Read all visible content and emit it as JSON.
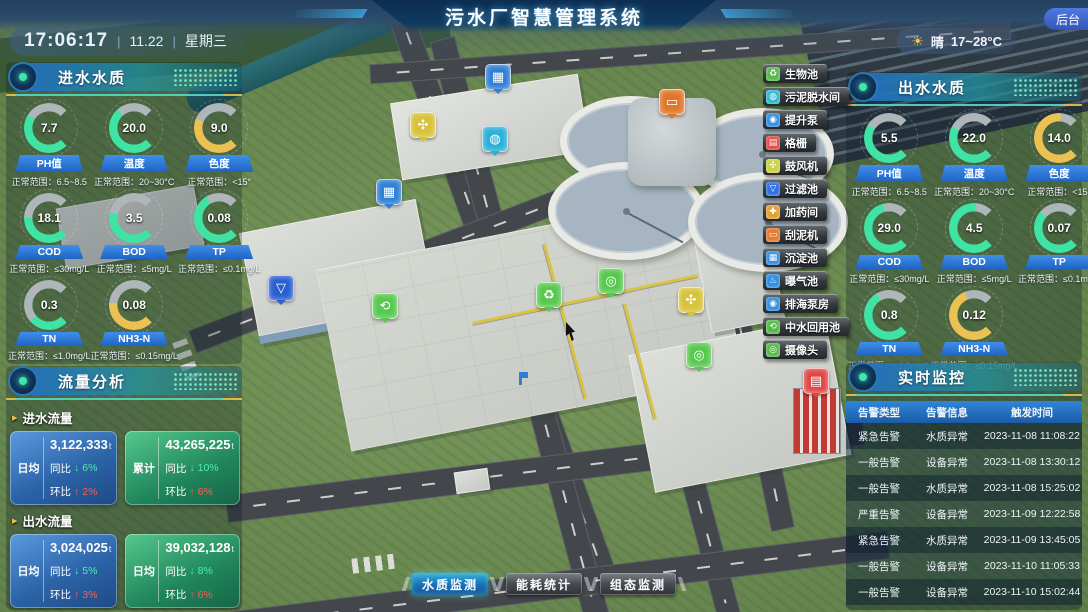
{
  "header": {
    "title": "污水厂智慧管理系统",
    "time": "17:06:17",
    "date": "11.22",
    "weekday": "星期三",
    "sun_icon": "☀",
    "weather_label": "晴",
    "weather_temp": "17~28°C",
    "admin_label": "后台"
  },
  "inlet_quality": {
    "title": "进水水质",
    "gauges": [
      {
        "value": "7.7",
        "label": "PH值",
        "range": "正常范围：6.5~8.5",
        "status": "normal",
        "percent": "62"
      },
      {
        "value": "20.0",
        "label": "温度",
        "range": "正常范围：20~30°C",
        "status": "normal",
        "percent": "68"
      },
      {
        "value": "9.0",
        "label": "色度",
        "range": "正常范围：<15°",
        "status": "warning",
        "percent": "58"
      },
      {
        "value": "18.1",
        "label": "COD",
        "range": "正常范围：≤30mg/L",
        "status": "normal",
        "percent": "50"
      },
      {
        "value": "3.5",
        "label": "BOD",
        "range": "正常范围：≤5mg/L",
        "status": "normal",
        "percent": "55"
      },
      {
        "value": "0.08",
        "label": "TP",
        "range": "正常范围：≤0.1mg/L",
        "status": "normal",
        "percent": "72"
      },
      {
        "value": "0.3",
        "label": "TN",
        "range": "正常范围：≤1.0mg/L",
        "status": "normal",
        "percent": "35"
      },
      {
        "value": "0.08",
        "label": "NH3-N",
        "range": "正常范围：≤0.15mg/L",
        "status": "warning",
        "percent": "52"
      }
    ]
  },
  "outlet_quality": {
    "title": "出水水质",
    "gauges": [
      {
        "value": "5.5",
        "label": "PH值",
        "range": "正常范围：6.5~8.5",
        "status": "normal",
        "percent": "62"
      },
      {
        "value": "22.0",
        "label": "温度",
        "range": "正常范围：20~30°C",
        "status": "normal",
        "percent": "60"
      },
      {
        "value": "14.0",
        "label": "色度",
        "range": "正常范围：<15°",
        "status": "warning",
        "percent": "85"
      },
      {
        "value": "29.0",
        "label": "COD",
        "range": "正常范围：≤30mg/L",
        "status": "normal",
        "percent": "78"
      },
      {
        "value": "4.5",
        "label": "BOD",
        "range": "正常范围：≤5mg/L",
        "status": "normal",
        "percent": "85"
      },
      {
        "value": "0.07",
        "label": "TP",
        "range": "正常范围：≤0.1mg/L",
        "status": "normal",
        "percent": "65"
      },
      {
        "value": "0.8",
        "label": "TN",
        "range": "正常范围：≤1.0mg/L",
        "status": "normal",
        "percent": "72"
      },
      {
        "value": "0.12",
        "label": "NH3-N",
        "range": "正常范围：≤0.15mg/L",
        "status": "warning",
        "percent": "75"
      }
    ]
  },
  "flow": {
    "title": "流量分析",
    "inlet_label": "进水流量",
    "outlet_label": "出水流量",
    "inlet_cards": [
      {
        "tag": "日均",
        "value": "3,122,333",
        "unit": "t",
        "theme": "blue",
        "yoy_label": "同比",
        "yoy_arrow": "↓",
        "yoy_value": "6%",
        "yoy_cls": "down",
        "mom_label": "环比",
        "mom_arrow": "↑",
        "mom_value": "2%",
        "mom_cls": "up"
      },
      {
        "tag": "累计",
        "value": "43,265,225",
        "unit": "t",
        "theme": "green",
        "yoy_label": "同比",
        "yoy_arrow": "↓",
        "yoy_value": "10%",
        "yoy_cls": "down",
        "mom_label": "环比",
        "mom_arrow": "↑",
        "mom_value": "6%",
        "mom_cls": "up"
      }
    ],
    "outlet_cards": [
      {
        "tag": "日均",
        "value": "3,024,025",
        "unit": "t",
        "theme": "blue",
        "yoy_label": "同比",
        "yoy_arrow": "↓",
        "yoy_value": "5%",
        "yoy_cls": "down",
        "mom_label": "环比",
        "mom_arrow": "↑",
        "mom_value": "3%",
        "mom_cls": "up"
      },
      {
        "tag": "日均",
        "value": "39,032,128",
        "unit": "t",
        "theme": "green",
        "yoy_label": "同比",
        "yoy_arrow": "↓",
        "yoy_value": "8%",
        "yoy_cls": "down",
        "mom_label": "环比",
        "mom_arrow": "↑",
        "mom_value": "6%",
        "mom_cls": "up"
      }
    ]
  },
  "monitor": {
    "title": "实时监控",
    "columns": [
      "告警类型",
      "告警信息",
      "触发时间"
    ],
    "rows": [
      {
        "type": "紧急告警",
        "info": "水质异常",
        "time": "2023-11-08 11:08:22"
      },
      {
        "type": "一般告警",
        "info": "设备异常",
        "time": "2023-11-08 13:30:12"
      },
      {
        "type": "一般告警",
        "info": "水质异常",
        "time": "2023-11-08 15:25:02"
      },
      {
        "type": "严重告警",
        "info": "设备异常",
        "time": "2023-11-09 12:22:58"
      },
      {
        "type": "紧急告警",
        "info": "水质异常",
        "time": "2023-11-09 13:45:05"
      },
      {
        "type": "一般告警",
        "info": "设备异常",
        "time": "2023-11-10 11:05:33"
      },
      {
        "type": "一般告警",
        "info": "设备异常",
        "time": "2023-11-10 15:02:44"
      }
    ]
  },
  "facilities": {
    "items": [
      {
        "label": "生物池",
        "color": "#57b84a",
        "glyph": "♻"
      },
      {
        "label": "污泥脱水间",
        "color": "#2fb9c9",
        "glyph": "◍"
      },
      {
        "label": "提升泵",
        "color": "#2f8fe0",
        "glyph": "◉"
      },
      {
        "label": "格栅",
        "color": "#e04b44",
        "glyph": "▤"
      },
      {
        "label": "鼓风机",
        "color": "#c9d23f",
        "glyph": "✣"
      },
      {
        "label": "过滤池",
        "color": "#2f6fe0",
        "glyph": "▽"
      },
      {
        "label": "加药间",
        "color": "#e0a32f",
        "glyph": "✚"
      },
      {
        "label": "刮泥机",
        "color": "#e07b2f",
        "glyph": "▭"
      },
      {
        "label": "沉淀池",
        "color": "#2f8fe0",
        "glyph": "▦"
      },
      {
        "label": "曝气池",
        "color": "#2f8fe0",
        "glyph": "♨"
      },
      {
        "label": "排海泵房",
        "color": "#2f8fe0",
        "glyph": "◉"
      },
      {
        "label": "中水回用池",
        "color": "#57b84a",
        "glyph": "⟲"
      },
      {
        "label": "摄像头",
        "color": "#57b84a",
        "glyph": "◎"
      }
    ]
  },
  "bottom_tabs": {
    "items": [
      {
        "label": "水质监测",
        "cls": "active"
      },
      {
        "label": "能耗统计",
        "cls": ""
      },
      {
        "label": "组态监测",
        "cls": ""
      }
    ]
  },
  "map_markers": {
    "items": [
      {
        "left": "485px",
        "top": "64px",
        "color": "#2f7fd4",
        "glyph": "▦",
        "name": "沉淀池"
      },
      {
        "left": "410px",
        "top": "112px",
        "color": "#d8c23a",
        "glyph": "✣",
        "name": "鼓风机"
      },
      {
        "left": "482px",
        "top": "126px",
        "color": "#2ab0d8",
        "glyph": "◍",
        "name": "污泥脱水间"
      },
      {
        "left": "659px",
        "top": "89px",
        "color": "#e0762a",
        "glyph": "▭",
        "name": "刮泥机"
      },
      {
        "left": "376px",
        "top": "179px",
        "color": "#2f7fd4",
        "glyph": "▦",
        "name": "沉淀池"
      },
      {
        "left": "268px",
        "top": "275px",
        "color": "#2a5fd0",
        "glyph": "▽",
        "name": "过滤池"
      },
      {
        "left": "372px",
        "top": "293px",
        "color": "#57c94f",
        "glyph": "⟲",
        "name": "中水回用池"
      },
      {
        "left": "536px",
        "top": "282px",
        "color": "#57c94f",
        "glyph": "♻",
        "name": "生物池"
      },
      {
        "left": "598px",
        "top": "268px",
        "color": "#57c94f",
        "glyph": "◎",
        "name": "摄像头"
      },
      {
        "left": "678px",
        "top": "287px",
        "color": "#d8c23a",
        "glyph": "✣",
        "name": "鼓风机"
      },
      {
        "left": "686px",
        "top": "342px",
        "color": "#57c94f",
        "glyph": "◎",
        "name": "摄像头"
      },
      {
        "left": "803px",
        "top": "368px",
        "color": "#e04545",
        "glyph": "▤",
        "name": "格栅"
      }
    ]
  },
  "colors": {
    "accent_normal": "#3fe3a4",
    "accent_warning": "#ecc153",
    "accent_down": "#4dedb0",
    "accent_up": "#ff5d52",
    "header_blue": "#2f86d8"
  }
}
